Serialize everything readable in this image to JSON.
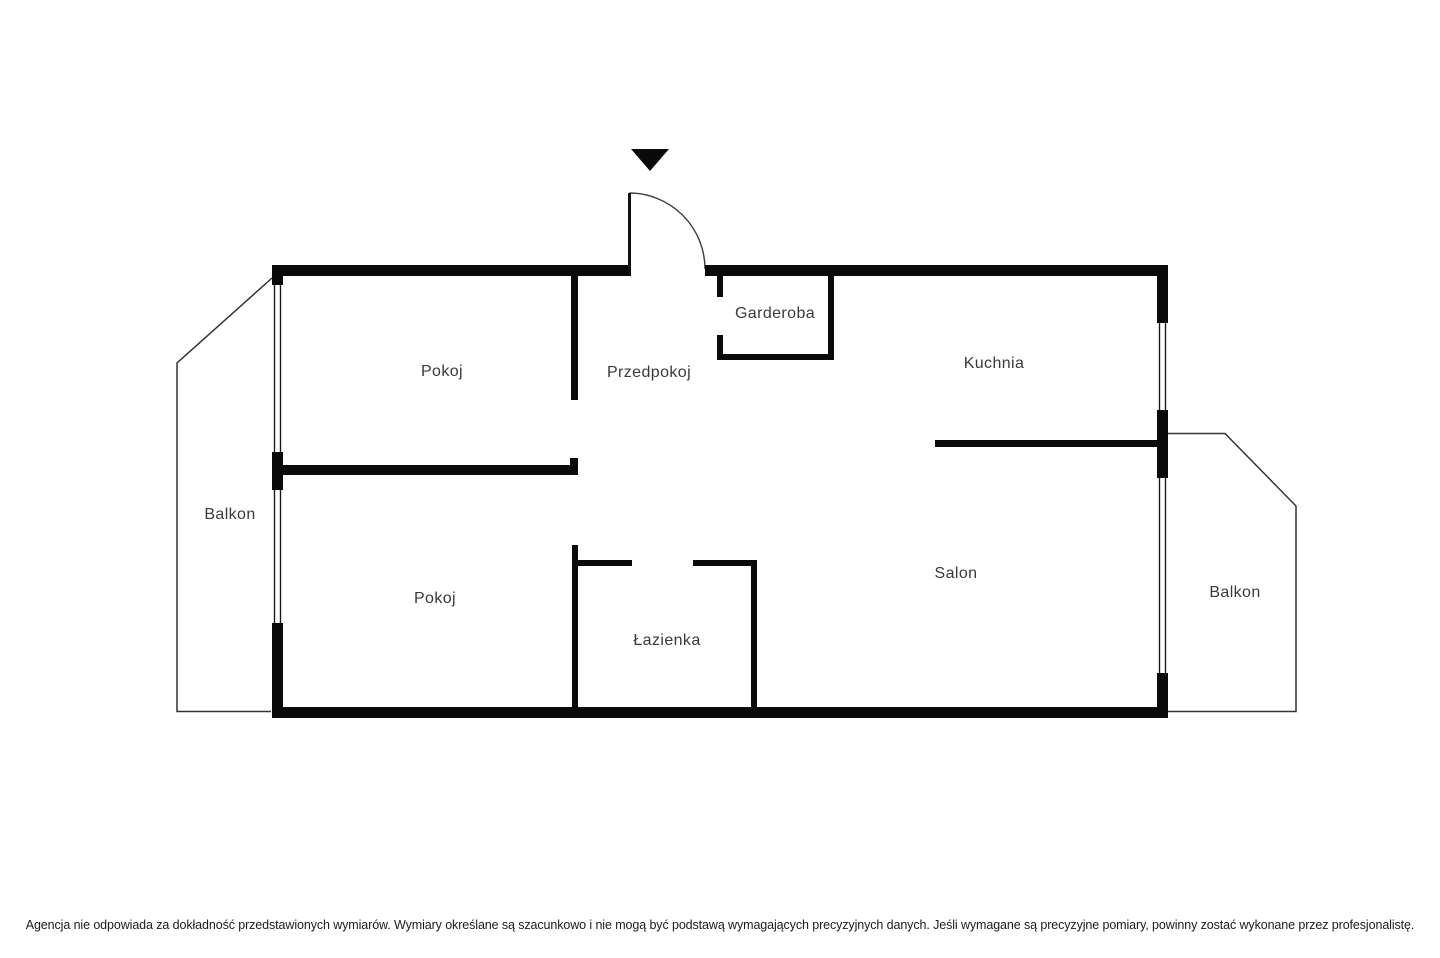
{
  "title": "Apartment floor plan",
  "colors": {
    "background": "#ffffff",
    "wall": "#0a0a0a",
    "label_text": "#3a3a3a",
    "disclaimer_text": "#1c1c1c"
  },
  "icons": {
    "entrance_marker": "entrance-arrow-icon",
    "door": "door-swing-icon",
    "window": "window-symbol"
  },
  "rooms": {
    "pokoj1": "Pokoj",
    "przedpokoj": "Przedpokoj",
    "garderoba": "Garderoba",
    "kuchnia": "Kuchnia",
    "salon": "Salon",
    "pokoj2": "Pokoj",
    "lazienka": "Łazienka",
    "balkon_left": "Balkon",
    "balkon_right": "Balkon"
  },
  "disclaimer": "Agencja nie odpowiada za dokładność przedstawionych wymiarów. Wymiary określane są szacunkowo i nie mogą być podstawą wymagających precyzyjnych danych. Jeśli wymagane są precyzyjne pomiary, powinny zostać wykonane przez profesjonalistę."
}
